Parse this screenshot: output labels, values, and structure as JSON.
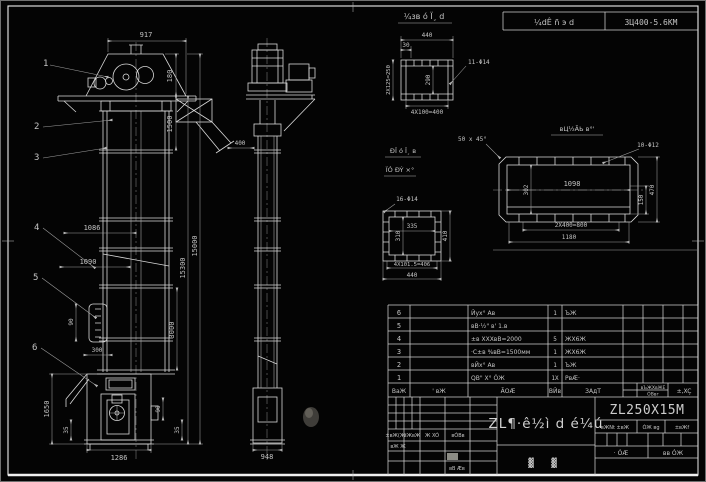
{
  "header": {
    "field1": "¼dÊ ñ э d",
    "field2": "3Ц400-5.6КМ"
  },
  "front": {
    "balloons": [
      "1",
      "2",
      "3",
      "4",
      "5",
      "6"
    ],
    "d917": "917",
    "d180": "180",
    "d1500": "1500",
    "d15300": "15300",
    "d15000": "15000",
    "d3000": "3000",
    "d1086": "1086",
    "d1090": "1090",
    "d90door": "90",
    "d300": "300",
    "d1650": "1650",
    "d35l": "35",
    "d90r": "90",
    "d35r": "35",
    "d1286": "1286"
  },
  "side": {
    "d400": "400",
    "d948": "948"
  },
  "det1": {
    "title": "¼зв ó Ï¸ d",
    "d440": "440",
    "d30": "30",
    "dleft": "2X125=250",
    "dinner": "290",
    "dbot": "4X100=400",
    "holes": "11-Φ14"
  },
  "det2": {
    "title": "вЦ½ÃЬ в°'",
    "chamfer": "50 x 45°",
    "holes": "10-Φ12",
    "d1098": "1098",
    "d302": "302",
    "d150": "150",
    "d470": "470",
    "d800": "2X400=800",
    "d1180": "1180"
  },
  "det3": {
    "title1": "ÐΪ ó Ï¸ в",
    "title2": "ÏÓ ÐÝ ×°",
    "holes": "16-Φ14",
    "d335": "335",
    "d310": "310",
    "d410": "410",
    "dbot": "4X101.5=406",
    "d440": "440"
  },
  "table": {
    "rows": [
      {
        "no": "6",
        "code": "",
        "name": "Йух° Ав",
        "qty": "1",
        "material": "ЪЖ"
      },
      {
        "no": "5",
        "code": "",
        "name": "вВ·½\" в' 1.в",
        "qty": "",
        "material": ""
      },
      {
        "no": "4",
        "code": "",
        "name": "±в XXXвВ=2000",
        "qty": "5",
        "material": "ЖX6Ж"
      },
      {
        "no": "3",
        "code": "",
        "name": "·C±в %вВ=1500мм",
        "qty": "1",
        "material": "ЖX6Ж"
      },
      {
        "no": "2",
        "code": "",
        "name": "вЙх° Ав",
        "qty": "1",
        "material": "ЪЖ"
      },
      {
        "no": "1",
        "code": "",
        "name": "QВ\" X° ÓЖ",
        "qty": "1X",
        "material": "РвÆ·"
      }
    ],
    "headers": {
      "no": "ВаЖ",
      "code": "' вЖ",
      "name": "ÃОÆ",
      "qty": "ВЙв",
      "material": "ЗАдТ",
      "extra1": "вЪЖXвЖЕ",
      "extra2": "ÓВвг",
      "extra3": "±,XÇ"
    }
  },
  "tb": {
    "title": "ZL¶·ê½ì d é¼ú",
    "sub1": "▓",
    "sub2": "▓",
    "model": "ZL250X15M",
    "small1": "вЖNt ±вЖ",
    "small2": "ÓЖ вg",
    "small3": "±вЖf",
    "sheet1": "· ÓÆ",
    "sheet2": "вв ÓЖ",
    "rev": {
      "r1c1": "±вЖ(Ж'",
      "r1c2": "вЖвЖ",
      "r1c3": "Ж XÓ",
      "r1c4": "вÓВв",
      "r2c1": "вЖ Ж",
      "r3c1": "вВ Æв"
    }
  }
}
